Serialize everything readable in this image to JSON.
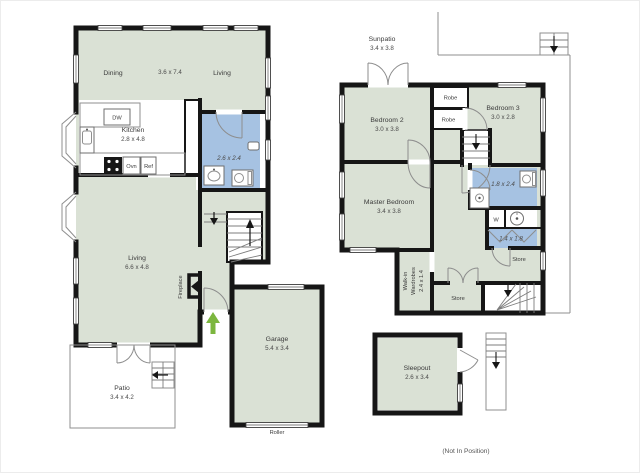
{
  "colors": {
    "wall": "#161616",
    "room": "#dae1d5",
    "wet": "#a6c2e2",
    "arrow": "#7cb63f",
    "thin_line": "#8f8f8f",
    "text": "#3b3b3b"
  },
  "ground_floor": {
    "dining_label": "Dining",
    "open_dims": "3.6 x 7.4",
    "living_top_label": "Living",
    "kitchen_label": "Kitchen",
    "kitchen_dims": "2.8 x 4.8",
    "dw_label": "DW",
    "ovn_label": "Ovn",
    "ref_label": "Ref",
    "bath_dims": "2.6 x 2.4",
    "living_label": "Living",
    "living_dims": "6.6 x 4.8",
    "fireplace_label": "Fireplace",
    "garage_label": "Garage",
    "garage_dims": "5.4 x 3.4",
    "roller_label": "Roller",
    "patio_label": "Patio",
    "patio_dims": "3.4 x 4.2"
  },
  "upper_floor": {
    "sunpatio_label": "Sunpatio",
    "sunpatio_dims": "3.4 x 3.8",
    "bedroom2_label": "Bedroom 2",
    "bedroom2_dims": "3.0 x 3.8",
    "robe1_label": "Robe",
    "robe2_label": "Robe",
    "bedroom3_label": "Bedroom 3",
    "bedroom3_dims": "3.0 x 2.8",
    "master_label": "Master Bedroom",
    "master_dims": "3.4 x 3.8",
    "bath_dims": "1.8 x 2.4",
    "washer_label": "W",
    "laundry_dims": "1.4 x 1.8",
    "store_upper_label": "Store",
    "store_lower_label": "Store",
    "walkin_line1": "Walk-in",
    "walkin_line2": "Wardrobes",
    "walkin_dims": "2.4 x 1.4",
    "sleepout_label": "Sleepout",
    "sleepout_dims": "2.6 x 3.4",
    "note": "(Not In Position)"
  }
}
